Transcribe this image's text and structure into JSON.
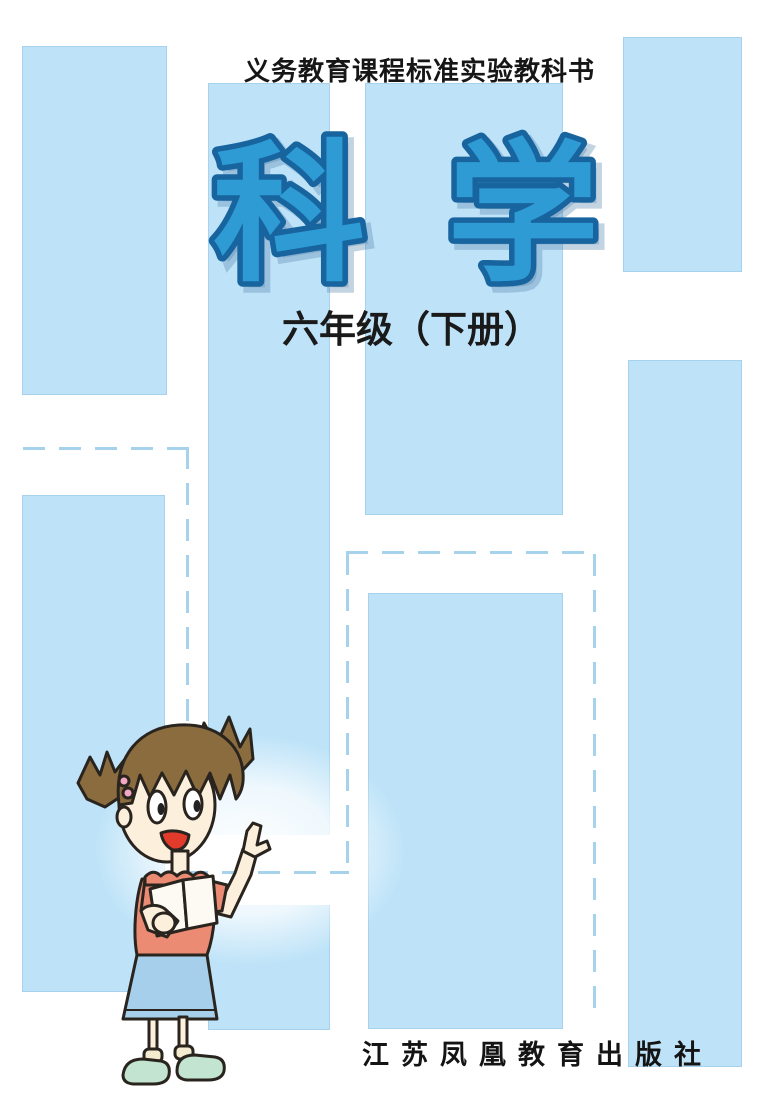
{
  "cover": {
    "series_label": "义务教育课程标准实验教科书",
    "title": "科学",
    "subtitle": "六年级（下册）",
    "publisher": "江苏凤凰教育出版社"
  },
  "illustration": {
    "name": "girl-pointing",
    "description": "Cartoon girl with brown pigtails, coral t-shirt and blue skirt, holding an open book and pointing upward"
  },
  "colors": {
    "block_blue": "#BEE3F8",
    "dash_blue": "#A6D2EC",
    "title_fill": "#2E9BD5",
    "title_outline": "#17649F",
    "text_black": "#161616",
    "shirt_coral": "#EB8B74",
    "skirt_blue": "#A5CFEA",
    "hair_brown": "#8B6C3F",
    "skin": "#FCEFDB",
    "shoe_green": "#C2E4D0"
  }
}
